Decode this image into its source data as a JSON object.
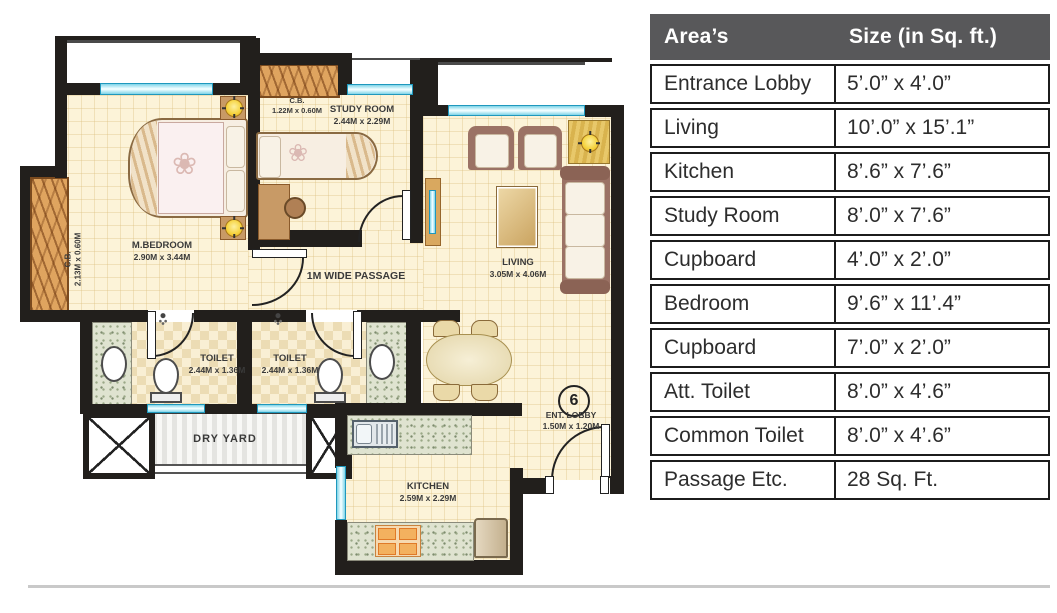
{
  "table": {
    "header": {
      "area": "Area’s",
      "size": "Size (in Sq. ft.)"
    },
    "rows": [
      {
        "area": "Entrance Lobby",
        "size": "5’.0” x 4’.0”"
      },
      {
        "area": "Living",
        "size": "10’.0” x 15’.1”"
      },
      {
        "area": "Kitchen",
        "size": "8’.6” x 7’.6”"
      },
      {
        "area": "Study Room",
        "size": "8’.0” x 7’.6”"
      },
      {
        "area": "Cupboard",
        "size": "4’.0” x 2’.0”"
      },
      {
        "area": "Bedroom",
        "size": "9’.6” x 11’.4”"
      },
      {
        "area": "Cupboard",
        "size": "7’.0” x 2’.0”"
      },
      {
        "area": "Att. Toilet",
        "size": "8’.0” x 4’.6”"
      },
      {
        "area": "Common Toilet",
        "size": "8’.0” x 4’.6”"
      },
      {
        "area": "Passage Etc.",
        "size": "28 Sq. Ft."
      }
    ]
  },
  "plan": {
    "unit_number": "6",
    "rooms": {
      "master_bedroom": {
        "name": "M.BEDROOM",
        "dims": "2.90M x 3.44M"
      },
      "study_room": {
        "name": "STUDY ROOM",
        "dims": "2.44M x 2.29M"
      },
      "living": {
        "name": "LIVING",
        "dims": "3.05M x 4.06M"
      },
      "toilet_attached": {
        "name": "TOILET",
        "dims": "2.44M x 1.36M"
      },
      "toilet_common": {
        "name": "TOILET",
        "dims": "2.44M x 1.36M"
      },
      "kitchen": {
        "name": "KITCHEN",
        "dims": "2.59M x 2.29M"
      },
      "dry_yard": {
        "name": "DRY YARD"
      },
      "entrance_lobby": {
        "name": "ENT. LOBBY",
        "dims": "1.50M x 1.20M"
      },
      "passage": {
        "name": "1M WIDE PASSAGE"
      },
      "cupboard_bedroom": {
        "name": "C.B.",
        "dims": "2.13M x 0.60M"
      },
      "cupboard_study": {
        "name": "C.B.",
        "dims": "1.22M x 0.60M"
      }
    },
    "colors": {
      "wall": "#221f1c",
      "floor": "#fcf3d8",
      "window": "#bfe9f2",
      "wood": "#dfa45f",
      "table_header_bg": "#58585a"
    }
  }
}
